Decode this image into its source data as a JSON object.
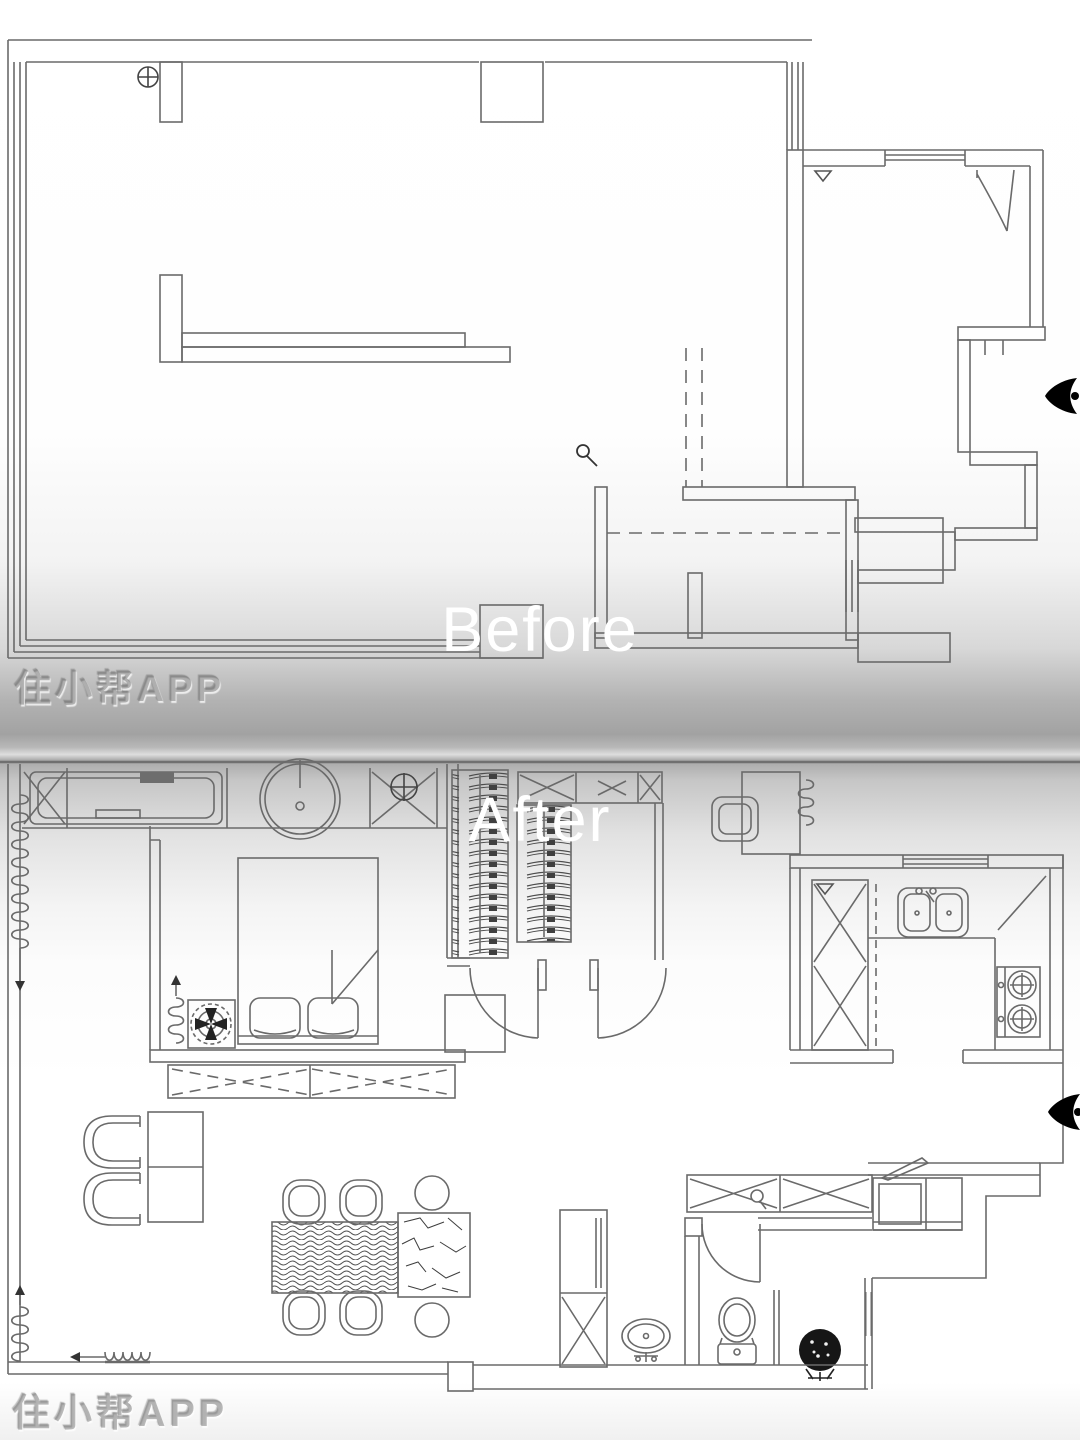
{
  "meta": {
    "content_type": "floor-plan-before-after-comparison",
    "app_watermark_runs": 2
  },
  "labels": {
    "before": "Before",
    "after": "After"
  },
  "watermark": {
    "text": "住小帮APP"
  },
  "palette": {
    "wall_line": "#6a6a6a",
    "furniture_line": "#4f4f4f",
    "symbol_dark": "#222222",
    "label_text": "#ffffff",
    "divider_gray": "#a2a2a2",
    "background": "#ffffff"
  },
  "icons": [
    {
      "name": "survey-point-icon",
      "glyph": "circle-cross",
      "location": "before-top-left"
    },
    {
      "name": "magnifier-icon",
      "glyph": "magnifier",
      "location": "before-center"
    },
    {
      "name": "door-swing-arc",
      "glyph": "quarter-arc",
      "location": "after-hall-doors"
    },
    {
      "name": "sight-direction-icon",
      "glyph": "eye-arrow",
      "location": "right-edge-before"
    },
    {
      "name": "sight-direction-icon",
      "glyph": "eye-arrow",
      "location": "right-edge-after"
    },
    {
      "name": "radiator-coil-icon",
      "glyph": "spring-coil",
      "count": 5
    },
    {
      "name": "ceiling-fan-icon",
      "glyph": "concentric-fan",
      "location": "after-left-bedroom"
    },
    {
      "name": "plant-icon",
      "glyph": "dark-shrub",
      "location": "after-bathroom"
    }
  ]
}
